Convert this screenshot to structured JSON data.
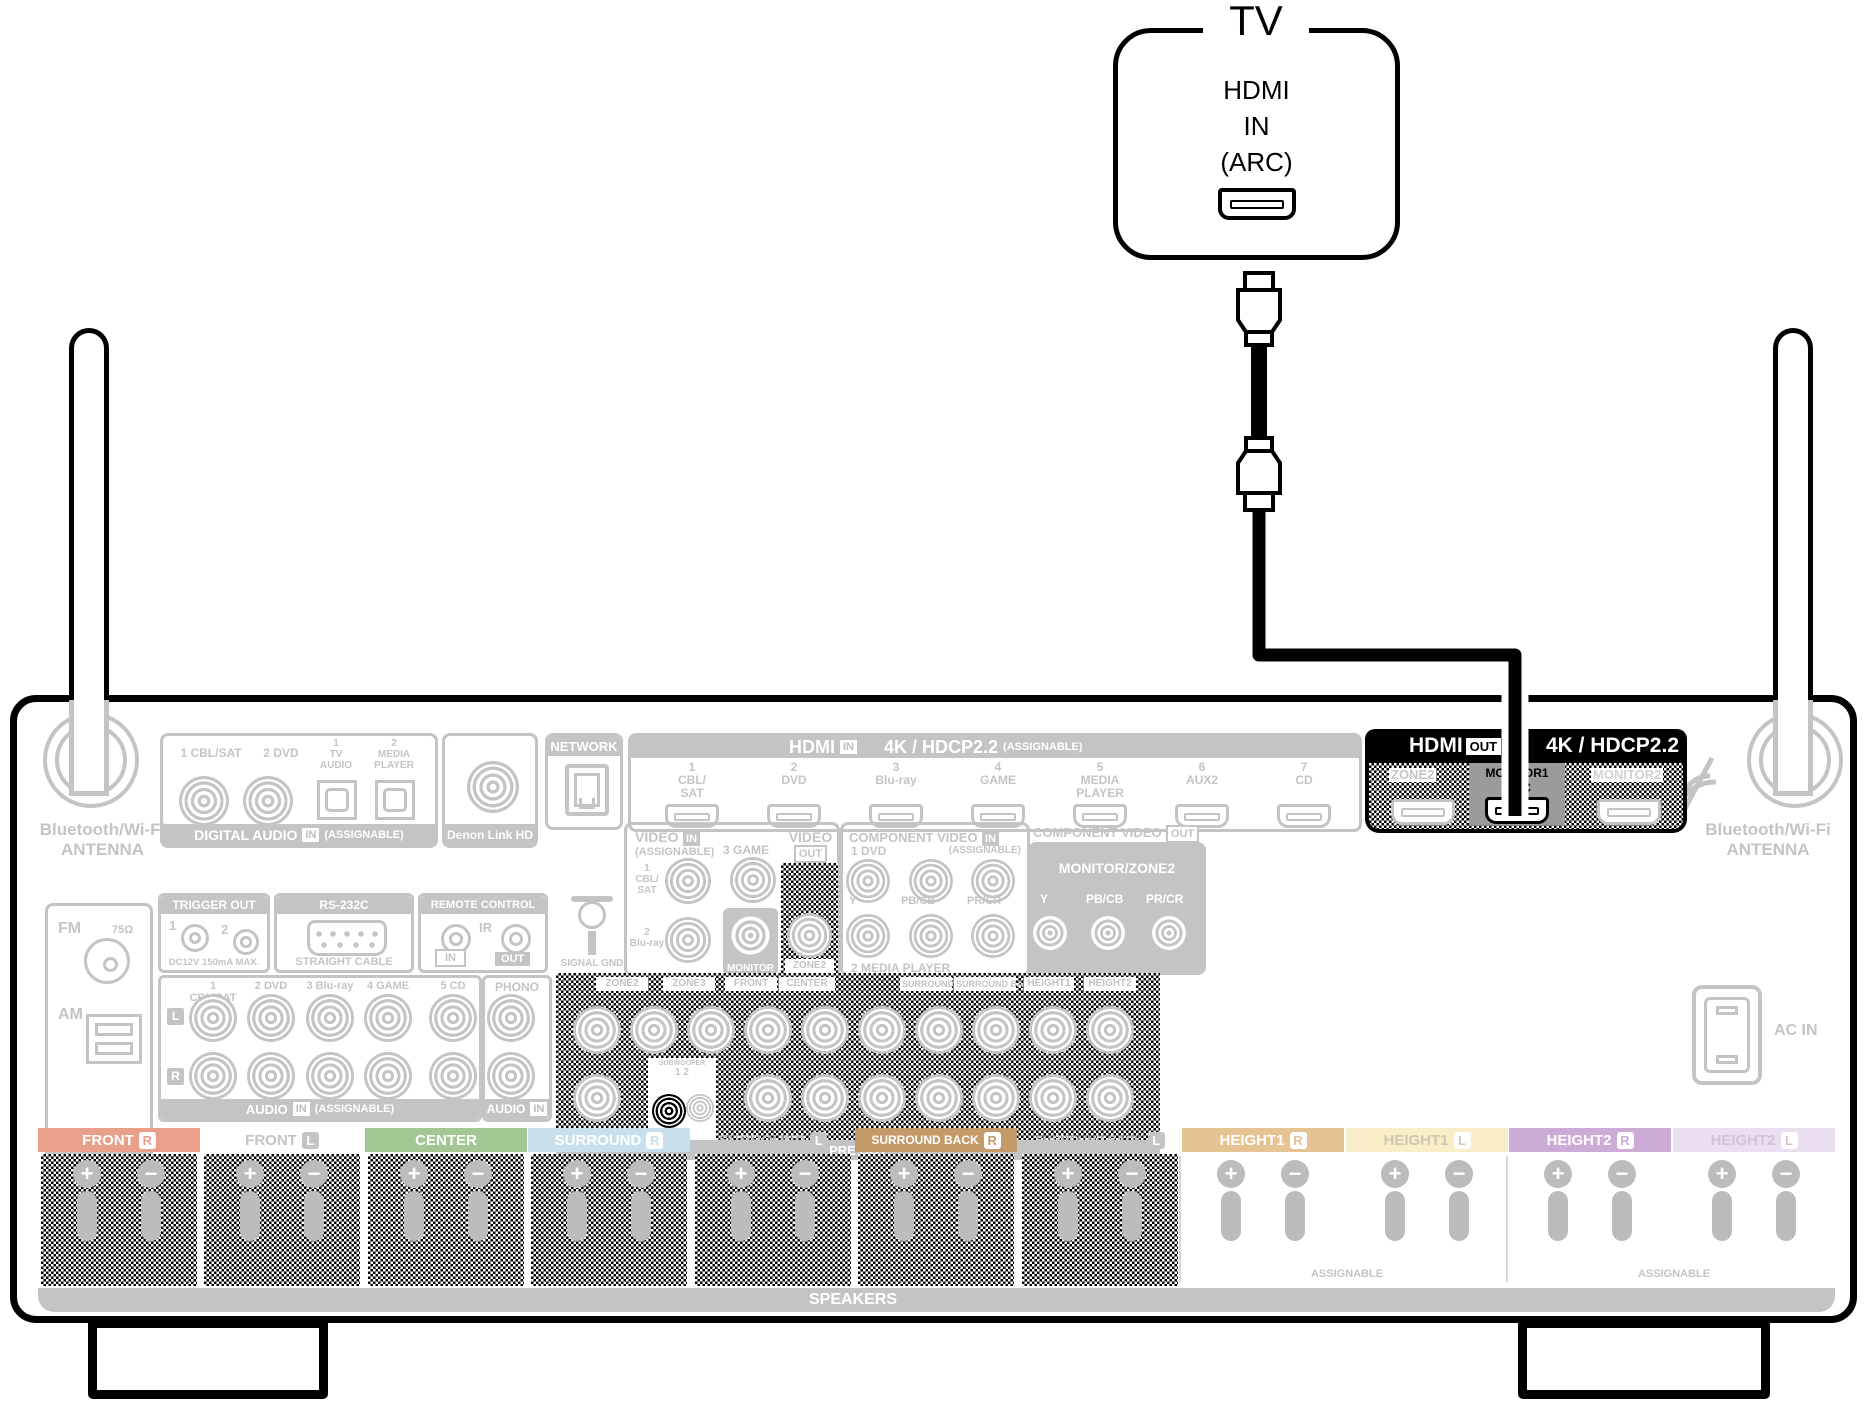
{
  "tv": {
    "title": "TV",
    "line1": "HDMI",
    "line2": "IN",
    "line3": "(ARC)"
  },
  "antenna_left": {
    "label": "Bluetooth/Wi-Fi\nANTENNA"
  },
  "antenna_right": {
    "label": "Bluetooth/Wi-Fi\nANTENNA"
  },
  "digital_audio": {
    "coax1": "1 CBL/SAT",
    "coax2": "2 DVD",
    "opt1": "1\nTV\nAUDIO",
    "opt2": "2\nMEDIA\nPLAYER",
    "coaxial": "COAXIAL",
    "optical": "OPTICAL",
    "footer": "DIGITAL AUDIO",
    "in_badge": "IN",
    "assignable": "(ASSIGNABLE)"
  },
  "denon_link": {
    "footer": "Denon Link HD"
  },
  "network": {
    "header": "NETWORK"
  },
  "hdmi_in": {
    "title": "HDMI",
    "in_badge": "IN",
    "spec": "4K / HDCP2.2",
    "assignable": "(ASSIGNABLE)",
    "ports": [
      {
        "label": "1\nCBL/\nSAT"
      },
      {
        "label": "2\nDVD"
      },
      {
        "label": "3\nBlu-ray"
      },
      {
        "label": "4\nGAME"
      },
      {
        "label": "5\nMEDIA\nPLAYER"
      },
      {
        "label": "6\nAUX2"
      },
      {
        "label": "7\nCD"
      }
    ]
  },
  "hdmi_out": {
    "title": "HDMI",
    "out_badge": "OUT",
    "spec": "4K / HDCP2.2",
    "zone2": "ZONE2",
    "monitor1": "MONITOR1",
    "arc": "ARC",
    "monitor2": "MONITOR2"
  },
  "video": {
    "in_title": "VIDEO",
    "in_badge": "IN",
    "assignable": "(ASSIGNABLE)",
    "cbl": "1\nCBL/\nSAT",
    "game": "3 GAME",
    "bluray": "2\nBlu-ray",
    "monitor": "MONITOR",
    "out_title": "VIDEO",
    "out_badge": "OUT",
    "zone2": "ZONE2"
  },
  "component_in": {
    "title": "COMPONENT VIDEO",
    "in_badge": "IN",
    "assignable": "(ASSIGNABLE)",
    "dvd": "1 DVD",
    "media": "2 MEDIA PLAYER",
    "y": "Y",
    "pb": "PB/CB",
    "pr": "PR/CR"
  },
  "component_out": {
    "title": "COMPONENT VIDEO",
    "out_badge": "OUT",
    "monitor": "MONITOR/ZONE2",
    "y": "Y",
    "pb": "PB/CB",
    "pr": "PR/CR"
  },
  "fm_am": {
    "fm": "FM",
    "ohm": "75Ω",
    "am": "AM",
    "footer": "ANTENNA"
  },
  "trigger": {
    "header": "TRIGGER OUT",
    "n1": "1",
    "n2": "2",
    "note": "DC12V 150mA MAX."
  },
  "rs232": {
    "header": "RS-232C",
    "note": "STRAIGHT CABLE"
  },
  "remote": {
    "header": "REMOTE CONTROL",
    "ir": "IR",
    "in_badge": "IN",
    "out_badge": "OUT"
  },
  "signal_gnd": {
    "label": "SIGNAL GND"
  },
  "audio": {
    "cols": [
      {
        "label": "1 CBL/SAT"
      },
      {
        "label": "2 DVD"
      },
      {
        "label": "3 Blu-ray"
      },
      {
        "label": "4 GAME"
      },
      {
        "label": "5 CD"
      }
    ],
    "l": "L",
    "r": "R",
    "footer": "AUDIO",
    "in_badge": "IN",
    "assignable": "(ASSIGNABLE)",
    "phono": "PHONO",
    "phono_footer": "AUDIO",
    "phono_in": "IN"
  },
  "pre_out": {
    "labels": [
      {
        "text": "ZONE2"
      },
      {
        "text": "ZONE3"
      },
      {
        "text": "FRONT"
      },
      {
        "text": "CENTER"
      },
      {
        "text": "SURROUND"
      },
      {
        "text": "SURROUND BACK"
      },
      {
        "text": "HEIGHT1"
      },
      {
        "text": "HEIGHT2"
      }
    ],
    "subwoofer": "SUBWOOFER",
    "nums": "1 2",
    "footer": "PRE OUT"
  },
  "ac_in": {
    "label": "AC IN"
  },
  "speakers": {
    "plus": "+",
    "minus": "−",
    "assignable": "ASSIGNABLE",
    "footer": "SPEAKERS",
    "sections": [
      {
        "label": "FRONT",
        "ch": "R"
      },
      {
        "label": "FRONT",
        "ch": "L"
      },
      {
        "label": "CENTER",
        "ch": ""
      },
      {
        "label": "SURROUND",
        "ch": "R"
      },
      {
        "label": "SURROUND",
        "ch": "L"
      },
      {
        "label": "SURROUND BACK",
        "ch": "R"
      },
      {
        "label": "SURROUND BACK",
        "ch": "L"
      },
      {
        "label": "HEIGHT1",
        "ch": "R"
      },
      {
        "label": "HEIGHT1",
        "ch": "L"
      },
      {
        "label": "HEIGHT2",
        "ch": "R"
      },
      {
        "label": "HEIGHT2",
        "ch": "L"
      }
    ]
  },
  "colors": {
    "faded_gray": "#c4c4c4",
    "highlight": "#000000",
    "monitor1_bg": "#9b9b9b",
    "front_r": "#e9a08b",
    "center": "#a2c694",
    "surround_r": "#c8e0ec",
    "surround_back_r": "#c59a69",
    "height1_r": "#e6c393",
    "height1_l": "#f8edc6",
    "height2_r": "#ccabd6",
    "height2_l": "#eadff0"
  }
}
